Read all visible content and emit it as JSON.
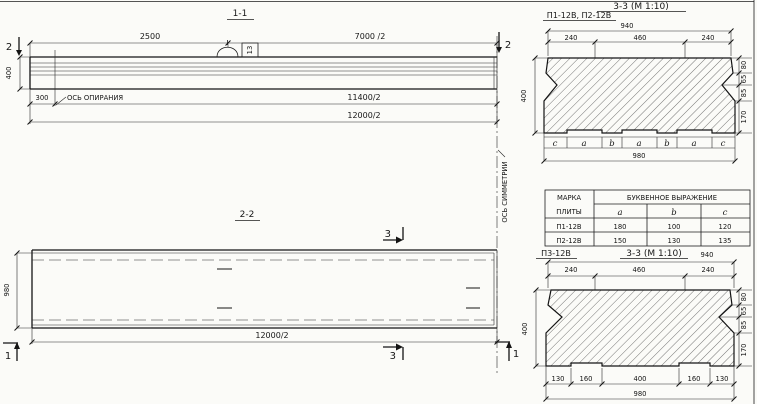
{
  "s11": {
    "title": "1-1",
    "dim_2500": "2500",
    "dim_7000": "7000 /2",
    "dim_400": "400",
    "dim_300": "300",
    "support_axis_label": "ОСЬ ОПИРАНИЯ",
    "dim_11400": "11400/2",
    "dim_12000": "12000/2",
    "marker_left": "2",
    "marker_right": "2",
    "loop_mark": "13"
  },
  "symmetry_axis_label": "ОСЬ СИММЕТРИИ",
  "s22": {
    "title": "2-2",
    "dim_980": "980",
    "dim_12000": "12000/2",
    "marker_top": "3",
    "marker_bottom": "3",
    "marker_left": "1",
    "marker_right": "1"
  },
  "s33top": {
    "plates_label": "П1-12В, П2-12В",
    "title": "3-3 (М 1:10)",
    "dim_940": "940",
    "dim_240l": "240",
    "dim_460": "460",
    "dim_240r": "240",
    "dim_400": "400",
    "r_80": "80",
    "r_65": "65",
    "r_85": "85",
    "r_170": "170",
    "letters": [
      "c",
      "a",
      "b",
      "a",
      "b",
      "a",
      "c"
    ],
    "dim_980": "980"
  },
  "table": {
    "col_mark_line1": "МАРКА",
    "col_mark_line2": "ПЛИТЫ",
    "group_header": "БУКВЕННОЕ  ВЫРАЖЕНИЕ",
    "col_a": "a",
    "col_b": "b",
    "col_c": "c",
    "rows": [
      {
        "mark": "П1-12В",
        "a": "180",
        "b": "100",
        "c": "120"
      },
      {
        "mark": "П2-12В",
        "a": "150",
        "b": "130",
        "c": "135"
      }
    ]
  },
  "s33bot": {
    "plate_label": "П3-12В",
    "title": "3-3 (М 1:10)",
    "dim_940": "940",
    "dim_240l": "240",
    "dim_460": "460",
    "dim_240r": "240",
    "dim_400": "400",
    "r_80": "80",
    "r_65": "65",
    "r_85": "85",
    "r_170": "170",
    "b_130l": "130",
    "b_160l": "160",
    "b_400": "400",
    "b_160r": "160",
    "b_130r": "130",
    "dim_980": "980"
  }
}
